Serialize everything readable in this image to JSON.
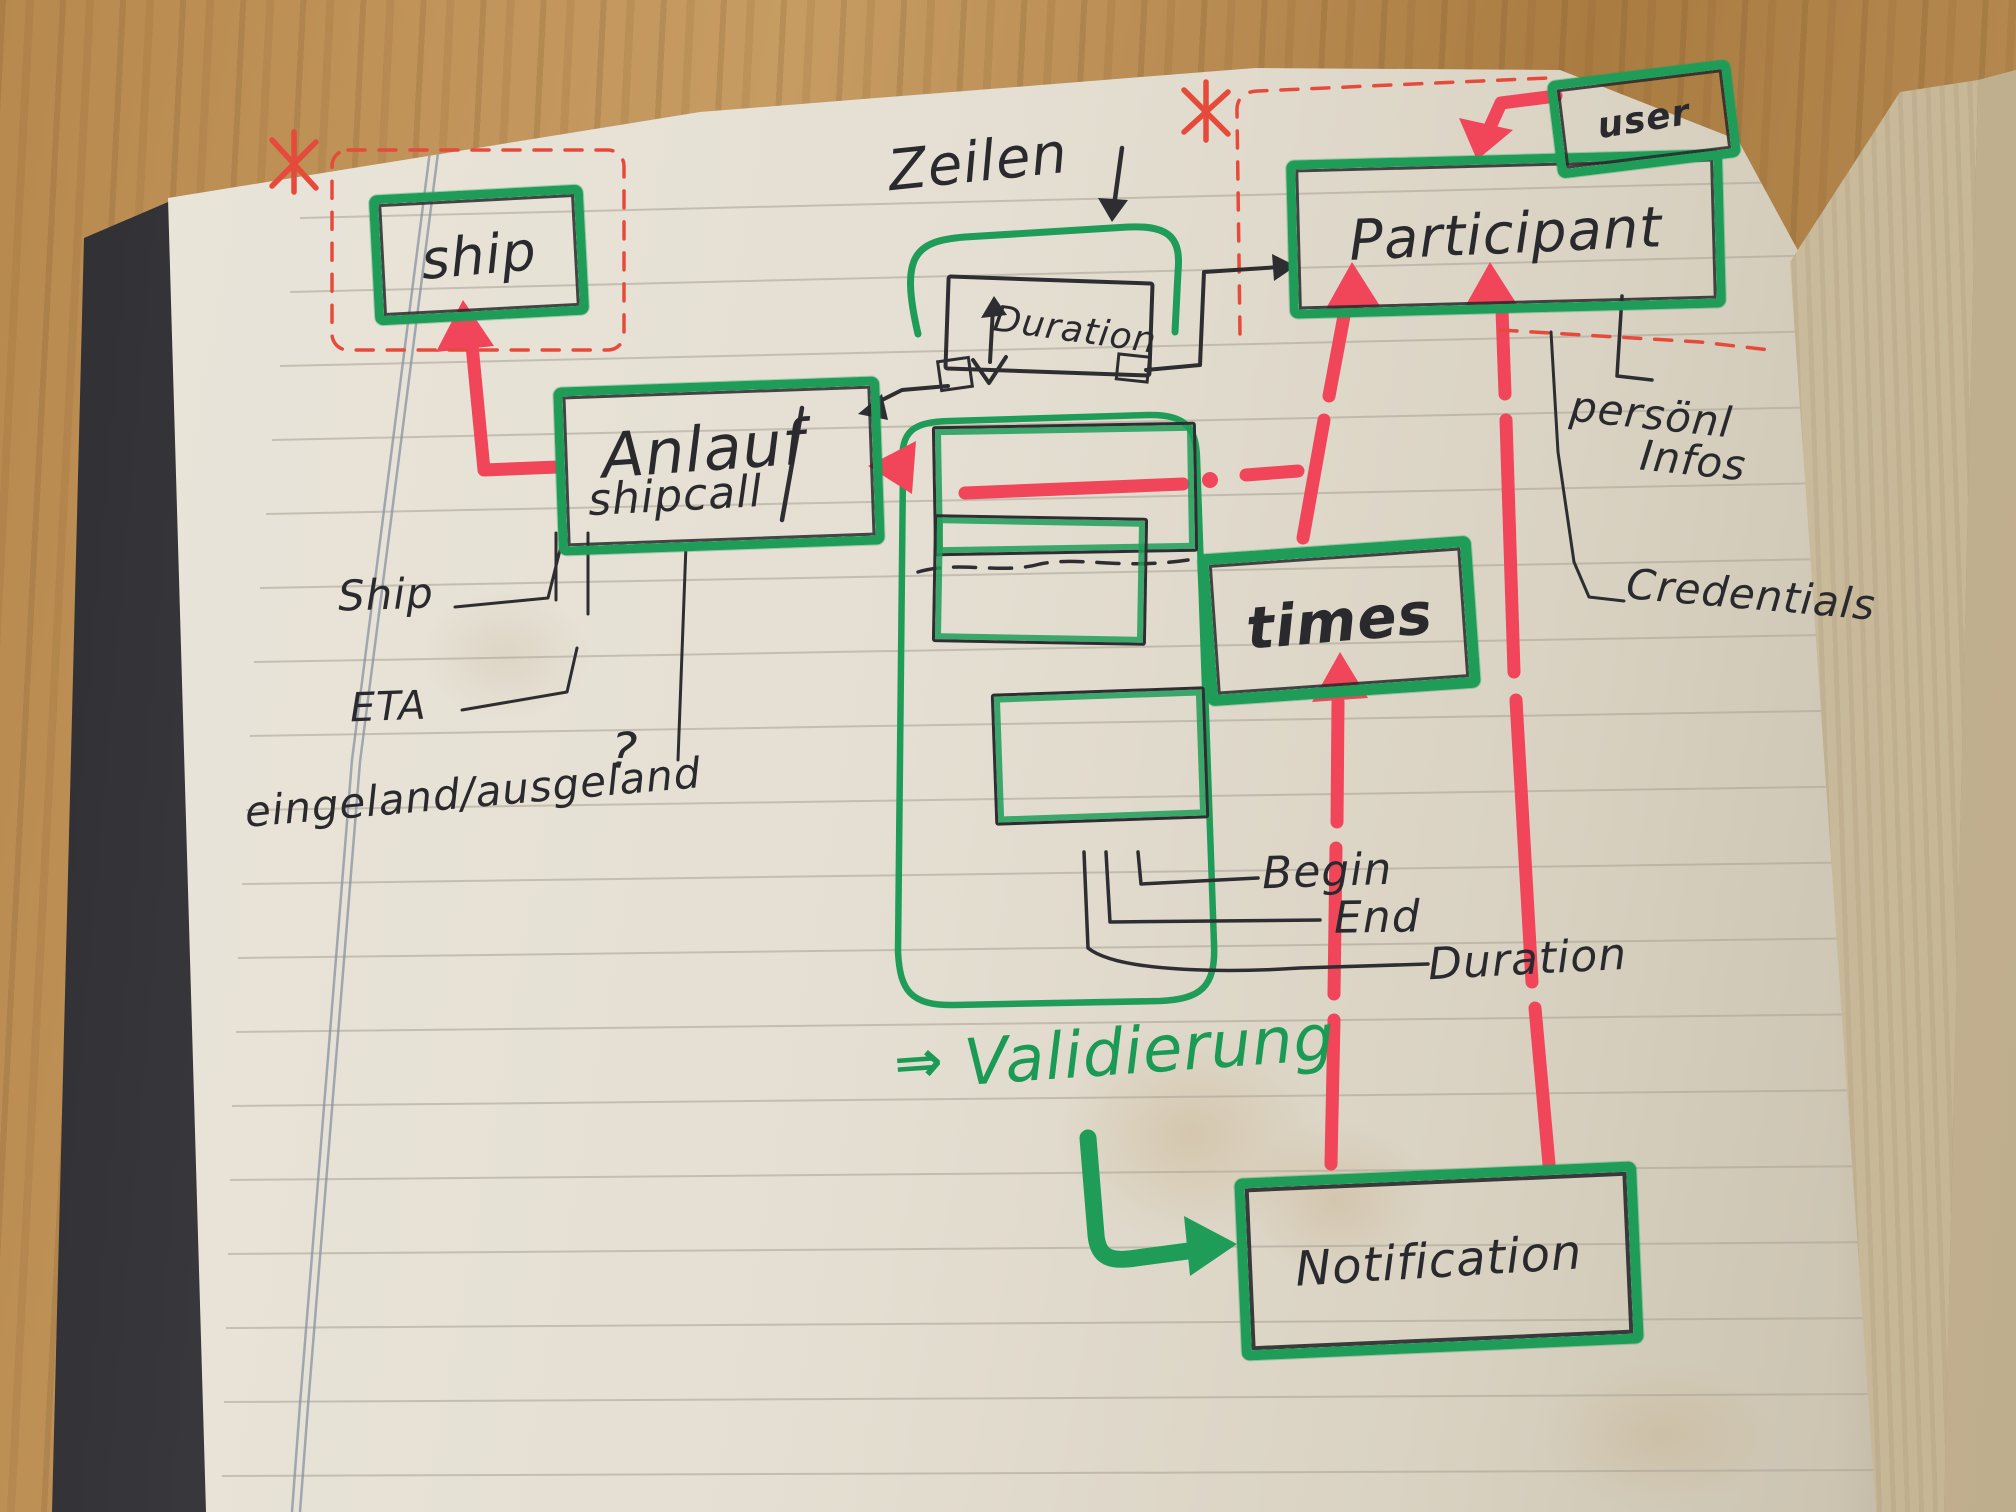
{
  "notebook": {
    "boxes": {
      "ship": "ship",
      "anlauf": "Anlauf",
      "shipcall": "shipcall",
      "participant": "Participant",
      "user": "user",
      "times": "times",
      "notification": "Notification",
      "duration_small": "Duration"
    },
    "annotations": {
      "zeilen": "Zeilen",
      "ship_attr": "Ship",
      "eta": "ETA",
      "inout": "eingeland/ausgeland",
      "question_mark": "?",
      "begin": "Begin",
      "end": "End",
      "duration": "Duration",
      "personal": "persönl",
      "infos": "Infos",
      "credentials": "Credentials",
      "validierung_arrow": "⇒",
      "validierung": "Validierung"
    },
    "colors": {
      "marker_green": "#1f9d58",
      "marker_red": "#f1455a",
      "pen_red": "#e64a3a",
      "pen_black": "#2e2e32",
      "page": "#e5dfd3",
      "wood": "#b8894e"
    }
  }
}
